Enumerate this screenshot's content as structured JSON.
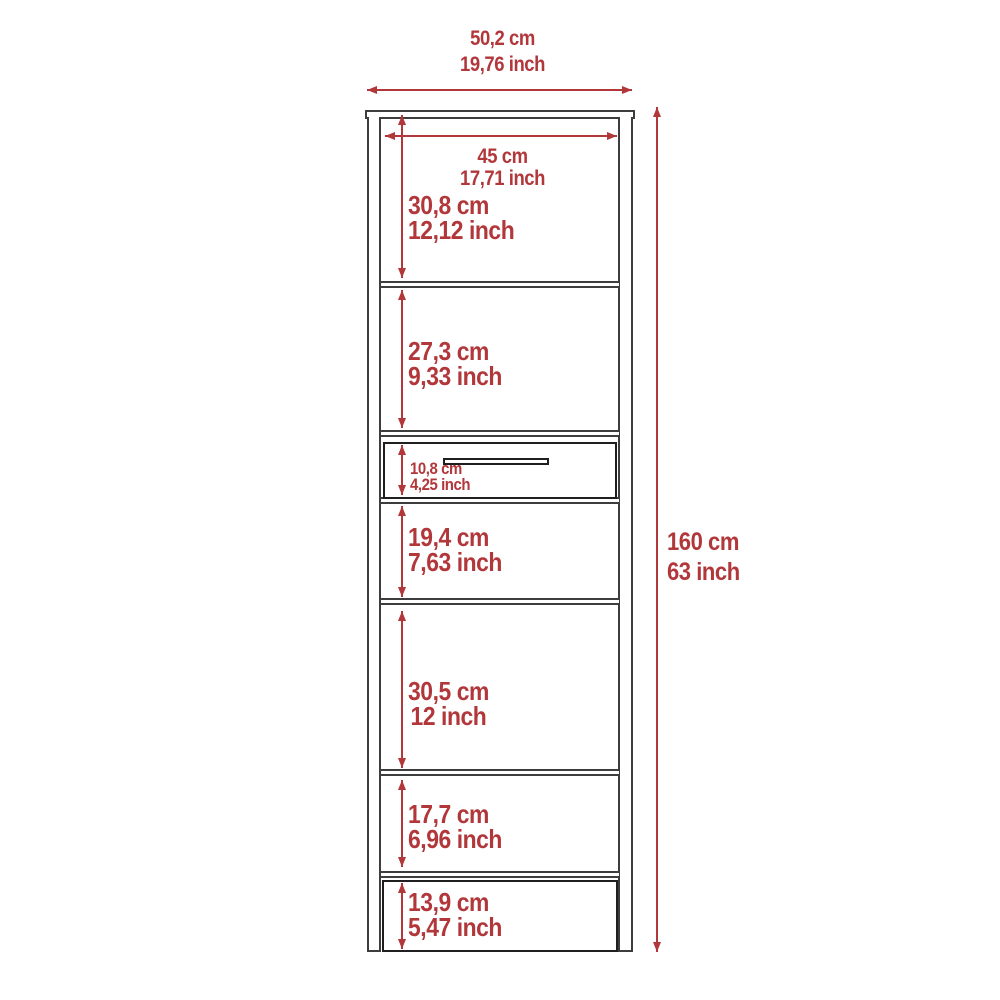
{
  "diagram": {
    "accent_color": "#b2373b",
    "line_color": "#3d3d3d",
    "overall_width": {
      "cm": "50,2 cm",
      "inch": "19,76 inch"
    },
    "overall_height": {
      "cm": "160 cm",
      "inch": "63 inch"
    },
    "inner_width": {
      "cm": "45 cm",
      "inch": "17,71 inch"
    },
    "sections": [
      {
        "cm": "30,8 cm",
        "inch": "12,12 inch"
      },
      {
        "cm": "27,3 cm",
        "inch": "9,33 inch"
      },
      {
        "cm": "10,8 cm",
        "inch": "4,25 inch"
      },
      {
        "cm": "19,4 cm",
        "inch": "7,63 inch"
      },
      {
        "cm": "30,5 cm",
        "inch": "12 inch"
      },
      {
        "cm": "17,7 cm",
        "inch": "6,96 inch"
      },
      {
        "cm": "13,9 cm",
        "inch": "5,47 inch"
      }
    ]
  }
}
